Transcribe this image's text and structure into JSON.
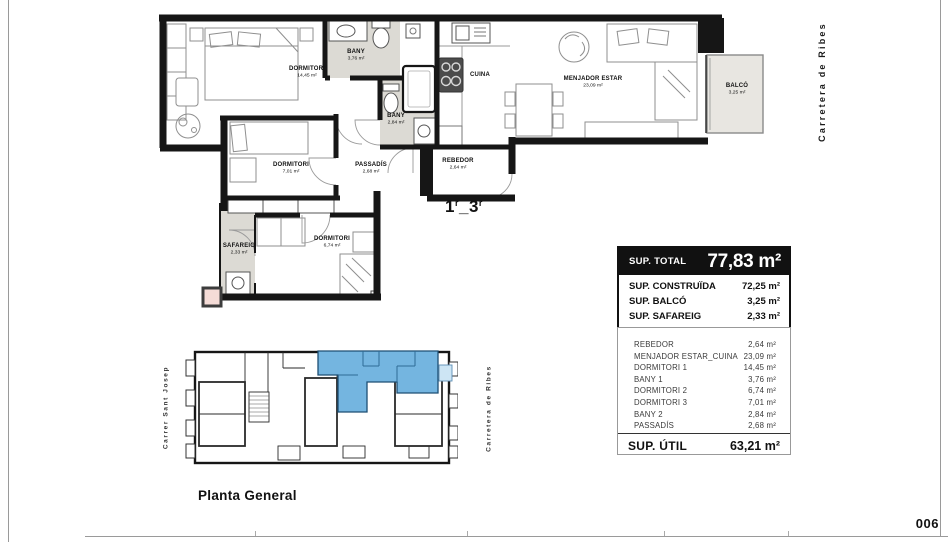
{
  "page": {
    "number": "006"
  },
  "streets": {
    "right_large": "Carretera de Ribes",
    "site_left": "Carrer Sant Josep",
    "site_right": "Carretera de Ribes"
  },
  "unit_mark": {
    "p1": "1",
    "s1": "r",
    "p2": "_3",
    "s2": "r"
  },
  "plan_labels": {
    "dormitori1": {
      "name": "DORMITORI",
      "area": "14,45 m²"
    },
    "bany1": {
      "name": "BANY",
      "area": "3,76 m²"
    },
    "cuina": {
      "name": "CUINA"
    },
    "menjador": {
      "name": "MENJADOR ESTAR",
      "area": "23,09 m²"
    },
    "balco": {
      "name": "BALCÓ",
      "area": "3,25 m²"
    },
    "dormitori3": {
      "name": "DORMITORI",
      "area": "7,01 m²"
    },
    "passadis": {
      "name": "PASSADÍS",
      "area": "2,68 m²"
    },
    "bany2": {
      "name": "BANY",
      "area": "2,84 m²"
    },
    "rebedor": {
      "name": "REBEDOR",
      "area": "2,64 m²"
    },
    "safareig": {
      "name": "SAFAREIG",
      "area": "2,33 m²"
    },
    "dormitori2": {
      "name": "DORMITORI",
      "area": "6,74 m²"
    }
  },
  "summary": {
    "total_label": "SUP. TOTAL",
    "total_value": "77,83 m²",
    "rows": [
      {
        "label": "SUP. CONSTRUÏDA",
        "value": "72,25 m²"
      },
      {
        "label": "SUP. BALCÓ",
        "value": "3,25 m²"
      },
      {
        "label": "SUP. SAFAREIG",
        "value": "2,33 m²"
      }
    ]
  },
  "room_list": {
    "rows": [
      {
        "label": "REBEDOR",
        "value": "2,64 m²"
      },
      {
        "label": "MENJADOR ESTAR_CUINA",
        "value": "23,09 m²"
      },
      {
        "label": "DORMITORI 1",
        "value": "14,45 m²"
      },
      {
        "label": "BANY 1",
        "value": "3,76 m²"
      },
      {
        "label": "DORMITORI 2",
        "value": "6,74 m²"
      },
      {
        "label": "DORMITORI 3",
        "value": "7,01 m²"
      },
      {
        "label": "BANY 2",
        "value": "2,84 m²"
      },
      {
        "label": "PASSADÍS",
        "value": "2,68 m²"
      }
    ],
    "total_label": "SUP. ÚTIL",
    "total_value": "63,21 m²"
  },
  "site_plan": {
    "title": "Planta General"
  },
  "colors": {
    "wall": "#161616",
    "wet_room": "#dcdad4",
    "balcony": "#e8e6e1",
    "highlight_blue": "#74b5e0",
    "highlight_blue_light": "#cde5f4",
    "pink_square": "#f5dcd7"
  }
}
